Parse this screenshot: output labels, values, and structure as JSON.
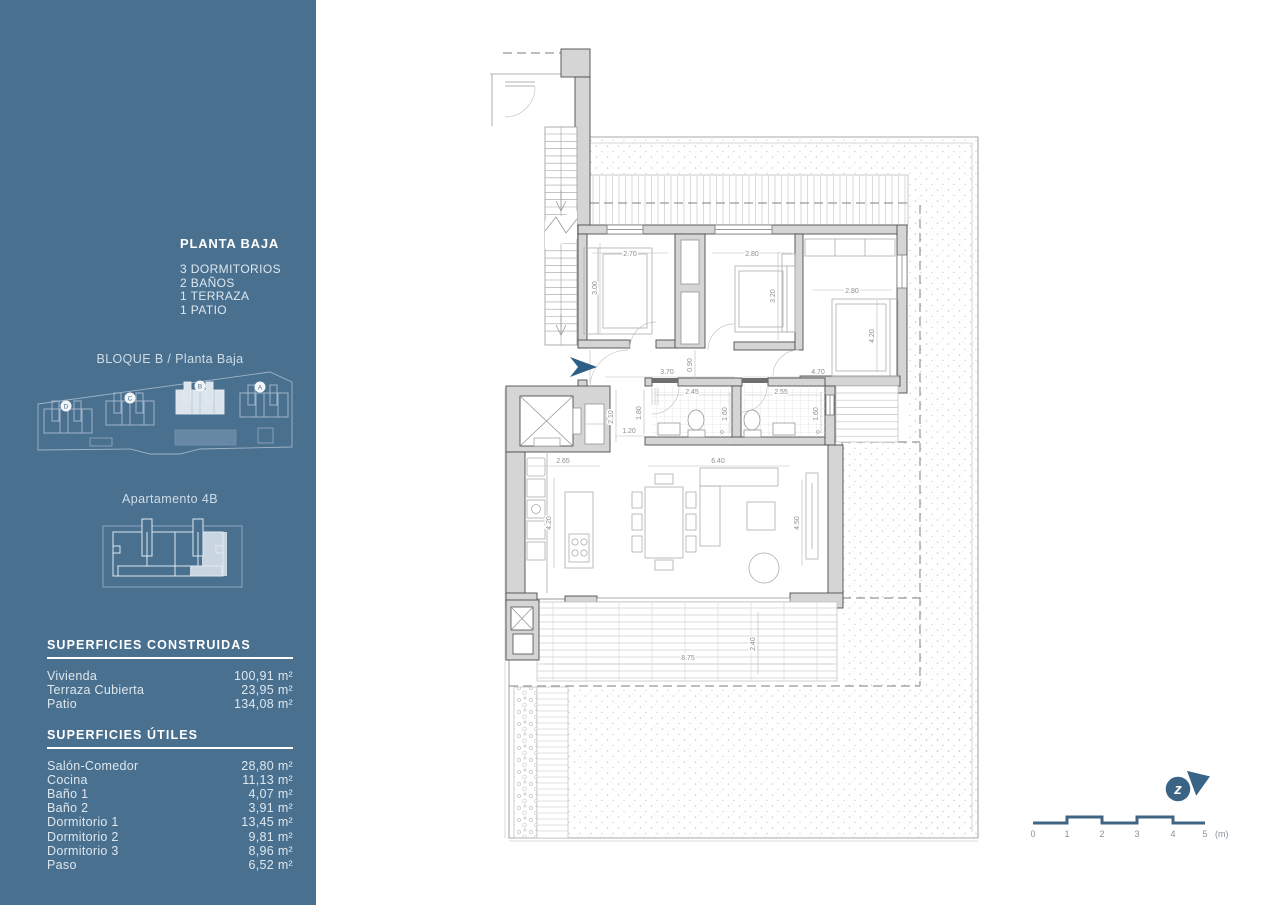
{
  "sidebar": {
    "title": "PLANTA BAJA",
    "features": [
      "3 DORMITORIOS",
      "2 BAÑOS",
      "1 TERRAZA",
      "1 PATIO"
    ],
    "block_label": "BLOQUE B / Planta Baja",
    "apartment_label": "Apartamento 4B",
    "site_badges": [
      "D",
      "C",
      "B",
      "A"
    ],
    "built_areas": {
      "heading": "SUPERFICIES CONSTRUIDAS",
      "rows": [
        {
          "label": "Vivienda",
          "value": "100,91 m²"
        },
        {
          "label": "Terraza Cubierta",
          "value": "23,95 m²"
        },
        {
          "label": "Patio",
          "value": "134,08 m²"
        }
      ]
    },
    "usable_areas": {
      "heading": "SUPERFICIES ÚTILES",
      "rows": [
        {
          "label": "Salón-Comedor",
          "value": "28,80 m²"
        },
        {
          "label": "Cocina",
          "value": "11,13 m²"
        },
        {
          "label": "Baño 1",
          "value": "4,07 m²"
        },
        {
          "label": "Baño 2",
          "value": "3,91 m²"
        },
        {
          "label": "Dormitorio 1",
          "value": "13,45 m²"
        },
        {
          "label": "Dormitorio 2",
          "value": "9,81 m²"
        },
        {
          "label": "Dormitorio 3",
          "value": "8,96 m²"
        },
        {
          "label": "Paso",
          "value": "6,52 m²"
        }
      ]
    }
  },
  "plan": {
    "dims": {
      "bed1_w": "2.70",
      "bed1_h": "3.00",
      "bed2_w": "2.80",
      "bed2_h": "3.20",
      "bed3_w": "2.80",
      "bed3_h": "4.20",
      "hall_w": "3.70",
      "hall_n": "0.90",
      "hall_e": "4.70",
      "bath1_w": "2.45",
      "bath1_hl": "1.80",
      "bath1_hr": "1.60",
      "bath2_w": "2.55",
      "bath2_hr": "1.60",
      "hall_v": "2.10",
      "hall_s": "1.20",
      "kitchen_w": "2.65",
      "kitchen_h": "4.20",
      "living_w": "6.40",
      "living_h": "4.50",
      "terrace_w": "8.75",
      "terrace_h": "2.40"
    },
    "scale": {
      "t0": "0",
      "t1": "1",
      "t2": "2",
      "t3": "3",
      "t4": "4",
      "t5": "5",
      "unit": "(m)"
    },
    "north_letter": "z"
  },
  "colors": {
    "sidebar_bg": "#4a7090",
    "accent_blue": "#2e5f86",
    "north_blue": "#3a6485",
    "scale_bar": "#3f6585",
    "wall_fill": "#d5d5d5",
    "wall_stroke": "#4d4d4d"
  }
}
